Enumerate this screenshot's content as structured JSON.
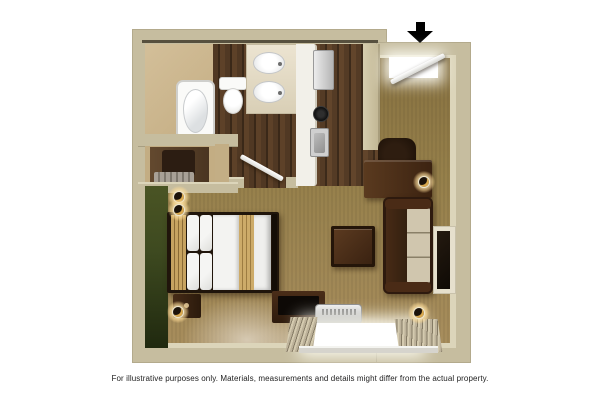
{
  "caption": "For illustrative purposes only.  Materials, measurements and details might differ from the actual property.",
  "icons": {
    "entry_arrow": "arrow-down-icon",
    "wall_lights": "sconce-light-icon"
  },
  "colors": {
    "wall": "#c6bd9f",
    "wall_inner": "#dcd5ba",
    "wood_floor_dark": "#4a3421",
    "carpet": "#9a8150",
    "carpet_light": "#d6c9b2",
    "accent_wall_green": "#3e4a20",
    "counter_white": "#f2f0e9",
    "fixture_white": "#fafaf8",
    "sofa_brown": "#2e1a0e",
    "cushion_beige": "#d0c6ae",
    "furniture_wood": "#4a2c17",
    "sconce_gold": "#d8a84e",
    "arrow_black": "#000000",
    "caption_text": "#222222"
  }
}
